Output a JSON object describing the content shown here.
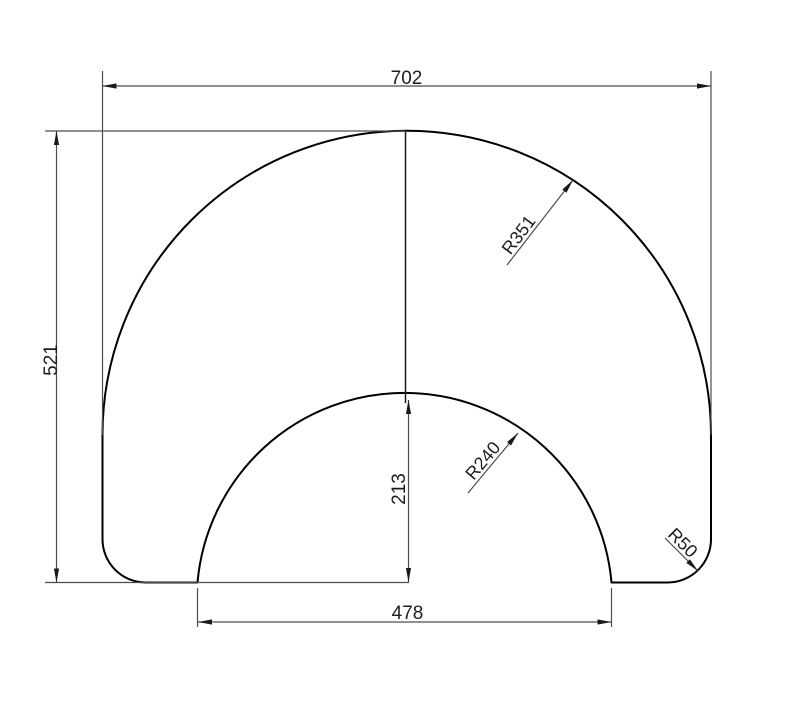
{
  "dims": {
    "width": "702",
    "height": "521",
    "inner_height": "213",
    "inner_width": "478",
    "outer_radius": "R351",
    "inner_radius": "R240",
    "corner_radius": "R50"
  },
  "colors": {
    "background": "#ffffff",
    "outline": "#000000",
    "centerline": "#1a1a1a",
    "dimension": "#4d4d4d",
    "arrow": "#1a1a1a",
    "text": "#1e1e1e"
  }
}
